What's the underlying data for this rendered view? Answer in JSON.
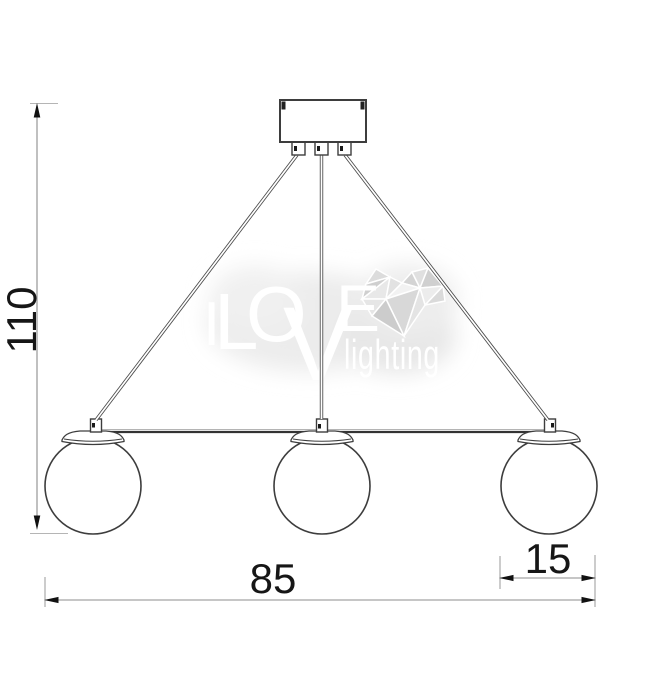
{
  "drawing": {
    "kind": "pendant-light-dimension-diagram",
    "lamp_count": 3,
    "dimensions": {
      "height": "110",
      "overall_width": "85",
      "shade_width": "15"
    }
  },
  "watermark": {
    "letters": [
      "I",
      "L",
      "O",
      "V",
      "E"
    ],
    "word": "lighting"
  },
  "colors": {
    "background": "#ffffff",
    "object_line": "#3d3d3d",
    "dimension_line": "#8c8c8c",
    "dimension_text": "#161616",
    "watermark_text": "#ffffff",
    "watermark_heart": "#d9d9d9"
  }
}
